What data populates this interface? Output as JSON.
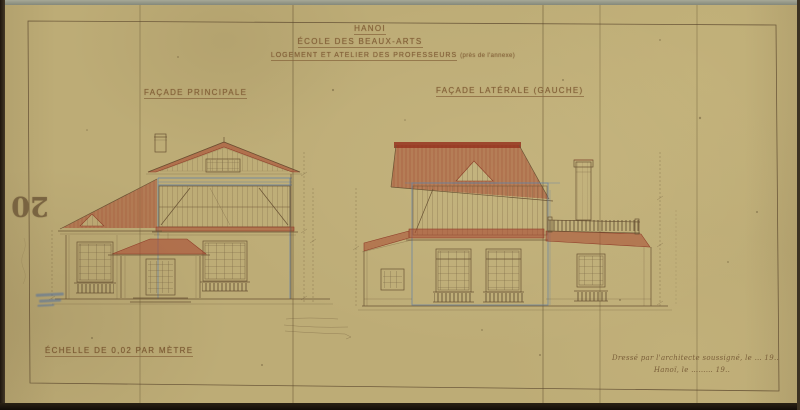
{
  "sheet": {
    "city": "HANOI",
    "institution": "ÉCOLE DES BEAUX-ARTS",
    "subject": "LOGEMENT ET ATELIER DES PROFESSEURS",
    "subject_note": "(près de l'annexe)",
    "left_elevation_label": "FAÇADE PRINCIPALE",
    "right_elevation_label": "FAÇADE LATÉRALE (GAUCHE)",
    "scale_note": "ÉCHELLE DE 0,02 PAR MÈTRE",
    "signature_line1": "Dressé par l'architecte soussigné, le … 19..",
    "signature_line2": "Hanoï, le ……… 19..",
    "margin_number": "20"
  },
  "colors": {
    "paper": "#bdac76",
    "ink_sepia": "#6a5334",
    "roof_red": "#a84a32",
    "line_blue": "#6482a5",
    "stamp_blue": "#4a6fa5"
  }
}
